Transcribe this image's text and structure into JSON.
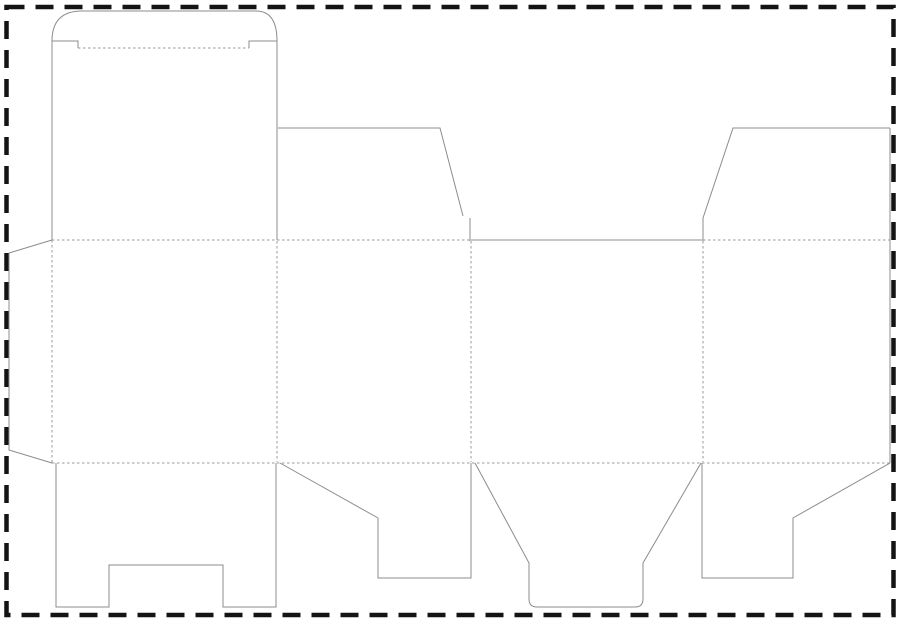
{
  "canvas": {
    "width": 900,
    "height": 627,
    "background": "#ffffff"
  },
  "colors": {
    "cut_line": "#8c8c8c",
    "fold_line": "#9a9a9a",
    "border": "#141414"
  },
  "border": {
    "x": 6.5,
    "y": 7,
    "width": 887,
    "height": 608,
    "stroke_width": 4.5,
    "dash": "18 11"
  },
  "dieline": {
    "stroke_width": 1,
    "fold_dash": "2.5 2.5",
    "cut_lines": [
      {
        "name": "lid-outline",
        "d": "M52,41 Q52,11 82,11 L256,11 Q277,11 277,41"
      },
      {
        "name": "lid-left-shoulder",
        "d": "M52,41 L78,41 L78,48"
      },
      {
        "name": "lid-right-shoulder",
        "d": "M249,48 L249,41 L277,41"
      },
      {
        "name": "panel1-left-edge",
        "d": "M52,41 L52,240"
      },
      {
        "name": "panel1-right-edge",
        "d": "M277,41 L277,240"
      },
      {
        "name": "top-flap2-edge",
        "d": "M278,128 L440,128 L463,216"
      },
      {
        "name": "top-flap2-tick",
        "d": "M470,218 L470,241"
      },
      {
        "name": "panel3-top-edge",
        "d": "M471,240 L702,240"
      },
      {
        "name": "top-flap4-tick",
        "d": "M703,218 L703,241"
      },
      {
        "name": "top-flap4-edge",
        "d": "M703,218 L733,128 L890,128"
      },
      {
        "name": "sheet-right-edge",
        "d": "M890,128 L890,463"
      },
      {
        "name": "glue-flap-outline",
        "d": "M52,240 L9,253 L9,450 L52,463"
      },
      {
        "name": "bottom-flap1-outline",
        "d": "M56,463 L56,607 L109,607 L109,565 L223,565 L223,607 L276,607 L276,463"
      },
      {
        "name": "bottom-flap2-outline",
        "d": "M280,463 L378,518 L378,578 L471,578 L471,463"
      },
      {
        "name": "bottom-tuck-flap-outline",
        "d": "M475,463 L529,563 L529,599 Q529,607 537,607 L635,607 Q643,607 643,599 L643,563 L701,463"
      },
      {
        "name": "bottom-flap4-outline",
        "d": "M702,463 L702,578 L793,578 L793,518 L890,463"
      }
    ],
    "fold_lines": [
      {
        "name": "lid-fold",
        "d": "M78,48 L249,48"
      },
      {
        "name": "top-fold-left",
        "d": "M52,240 L470,240"
      },
      {
        "name": "top-fold-right",
        "d": "M703,240 L890,240"
      },
      {
        "name": "bottom-fold",
        "d": "M52,463 L890,463"
      },
      {
        "name": "glue-flap-fold",
        "d": "M52,240 L52,463"
      },
      {
        "name": "fold-panel1-panel2",
        "d": "M277,241 L277,462"
      },
      {
        "name": "fold-panel2-panel3",
        "d": "M471,241 L471,462"
      },
      {
        "name": "fold-panel3-panel4",
        "d": "M703,241 L703,462"
      }
    ]
  }
}
